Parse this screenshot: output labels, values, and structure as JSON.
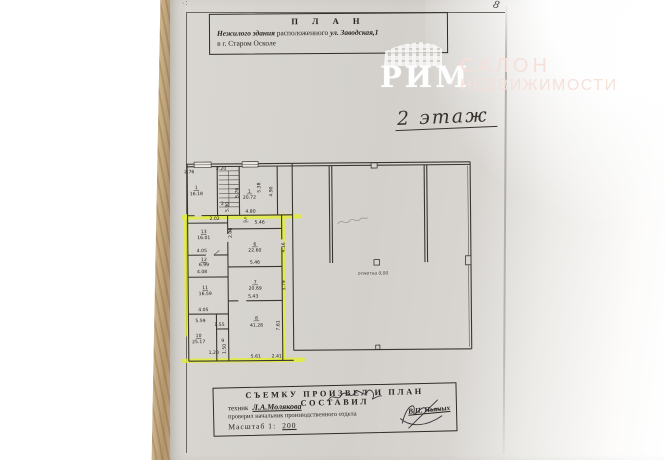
{
  "page": {
    "corner_mark": "8",
    "corner_dots": "·:"
  },
  "header_box": {
    "title": "П Л А Н",
    "line1_lead": "Нежилого здания",
    "line1_mid": " расположенного ",
    "line1_address": "ул. Заводская,1",
    "line2": "в г. Старом Осколе"
  },
  "watermark": {
    "brand": "РИМ",
    "salon_top": "САЛОН",
    "salon_bottom": "НЕДВИЖИМОСТИ"
  },
  "floor_label": "2 этаж",
  "plan": {
    "elevation_note": "отметка 0,00",
    "rooms": [
      {
        "number": "1",
        "area": "16.18"
      },
      {
        "number": "1",
        "area": "20.72"
      },
      {
        "number": "2",
        "area": ""
      },
      {
        "number": "5",
        "area": ""
      },
      {
        "number": "6",
        "area": "22.60"
      },
      {
        "number": "7",
        "area": "20.69"
      },
      {
        "number": "8",
        "area": "41.28"
      },
      {
        "number": "9",
        "area": ""
      },
      {
        "number": "10",
        "area": "25.17"
      },
      {
        "number": "11",
        "area": "16.59"
      },
      {
        "number": "12",
        "area": "6.99"
      },
      {
        "number": "13",
        "area": "16.01"
      }
    ],
    "labels": [
      {
        "t": "2.76",
        "x": 10,
        "y": 17
      },
      {
        "t": "2.20",
        "x": 42,
        "y": 14
      },
      {
        "t": "1",
        "x": 17,
        "y": 33,
        "u": 1
      },
      {
        "t": "16.18",
        "x": 17,
        "y": 39
      },
      {
        "t": "2",
        "x": 43,
        "y": 49
      },
      {
        "t": "5.90",
        "x": 49,
        "y": 51,
        "r": -90
      },
      {
        "t": "5.76",
        "x": 59,
        "y": 37,
        "r": -90
      },
      {
        "t": "1",
        "x": 70,
        "y": 37,
        "u": 1
      },
      {
        "t": "20.72",
        "x": 70,
        "y": 43
      },
      {
        "t": "5.38",
        "x": 81,
        "y": 32,
        "r": -90
      },
      {
        "t": "4.90",
        "x": 93,
        "y": 36,
        "r": -90
      },
      {
        "t": "4.80",
        "x": 71,
        "y": 57
      },
      {
        "t": "2.02",
        "x": 35,
        "y": 64
      },
      {
        "t": "5",
        "x": 66,
        "y": 65,
        "u": 1
      },
      {
        "t": "5.46",
        "x": 80,
        "y": 68
      },
      {
        "t": "2.06",
        "x": 52,
        "y": 77,
        "r": -90
      },
      {
        "t": "13",
        "x": 24,
        "y": 77,
        "u": 1
      },
      {
        "t": "16.01",
        "x": 24,
        "y": 83
      },
      {
        "t": "4.05",
        "x": 22,
        "y": 96
      },
      {
        "t": "12",
        "x": 24,
        "y": 105,
        "u": 1
      },
      {
        "t": "6.99",
        "x": 24,
        "y": 110
      },
      {
        "t": "4.08",
        "x": 22,
        "y": 117
      },
      {
        "t": "11",
        "x": 25,
        "y": 133,
        "u": 1
      },
      {
        "t": "16.59",
        "x": 25,
        "y": 139
      },
      {
        "t": "4.05",
        "x": 23,
        "y": 155
      },
      {
        "t": "5.59",
        "x": 20,
        "y": 166
      },
      {
        "t": "10",
        "x": 18,
        "y": 181,
        "u": 1
      },
      {
        "t": "25.17",
        "x": 18,
        "y": 187
      },
      {
        "t": "1.55",
        "x": 39,
        "y": 170
      },
      {
        "t": "9",
        "x": 42,
        "y": 186
      },
      {
        "t": "1.20",
        "x": 33,
        "y": 198
      },
      {
        "t": "1.50",
        "x": 45,
        "y": 193,
        "r": -90
      },
      {
        "t": "6",
        "x": 75,
        "y": 90,
        "u": 1
      },
      {
        "t": "22.60",
        "x": 75,
        "y": 96
      },
      {
        "t": "5.46",
        "x": 75,
        "y": 108
      },
      {
        "t": "4.16",
        "x": 105,
        "y": 92,
        "r": -90
      },
      {
        "t": "7",
        "x": 75,
        "y": 128,
        "u": 1
      },
      {
        "t": "20.69",
        "x": 75,
        "y": 134
      },
      {
        "t": "3.79",
        "x": 105,
        "y": 130,
        "r": -90
      },
      {
        "t": "5.43",
        "x": 73,
        "y": 142
      },
      {
        "t": "8",
        "x": 76,
        "y": 164,
        "u": 1
      },
      {
        "t": "41.28",
        "x": 76,
        "y": 171
      },
      {
        "t": "7.61",
        "x": 99,
        "y": 170,
        "r": -90
      },
      {
        "t": "5.61",
        "x": 75,
        "y": 202
      },
      {
        "t": "2.41",
        "x": 96,
        "y": 202
      },
      {
        "t": "отметка 0,00",
        "x": 193,
        "y": 120,
        "cls": "note"
      }
    ]
  },
  "footer_box": {
    "title": "СЪЕМКУ ПРОИЗВЕЛ И ПЛАН СОСТАВИЛ",
    "row1_role": "техник",
    "row1_name": "Л.А.Молякова",
    "row2_role": "проверил начальник производственного отдела",
    "row2_name": "В.П. Пьяных",
    "scale_label": "Масштаб 1:",
    "scale_value": "200"
  }
}
